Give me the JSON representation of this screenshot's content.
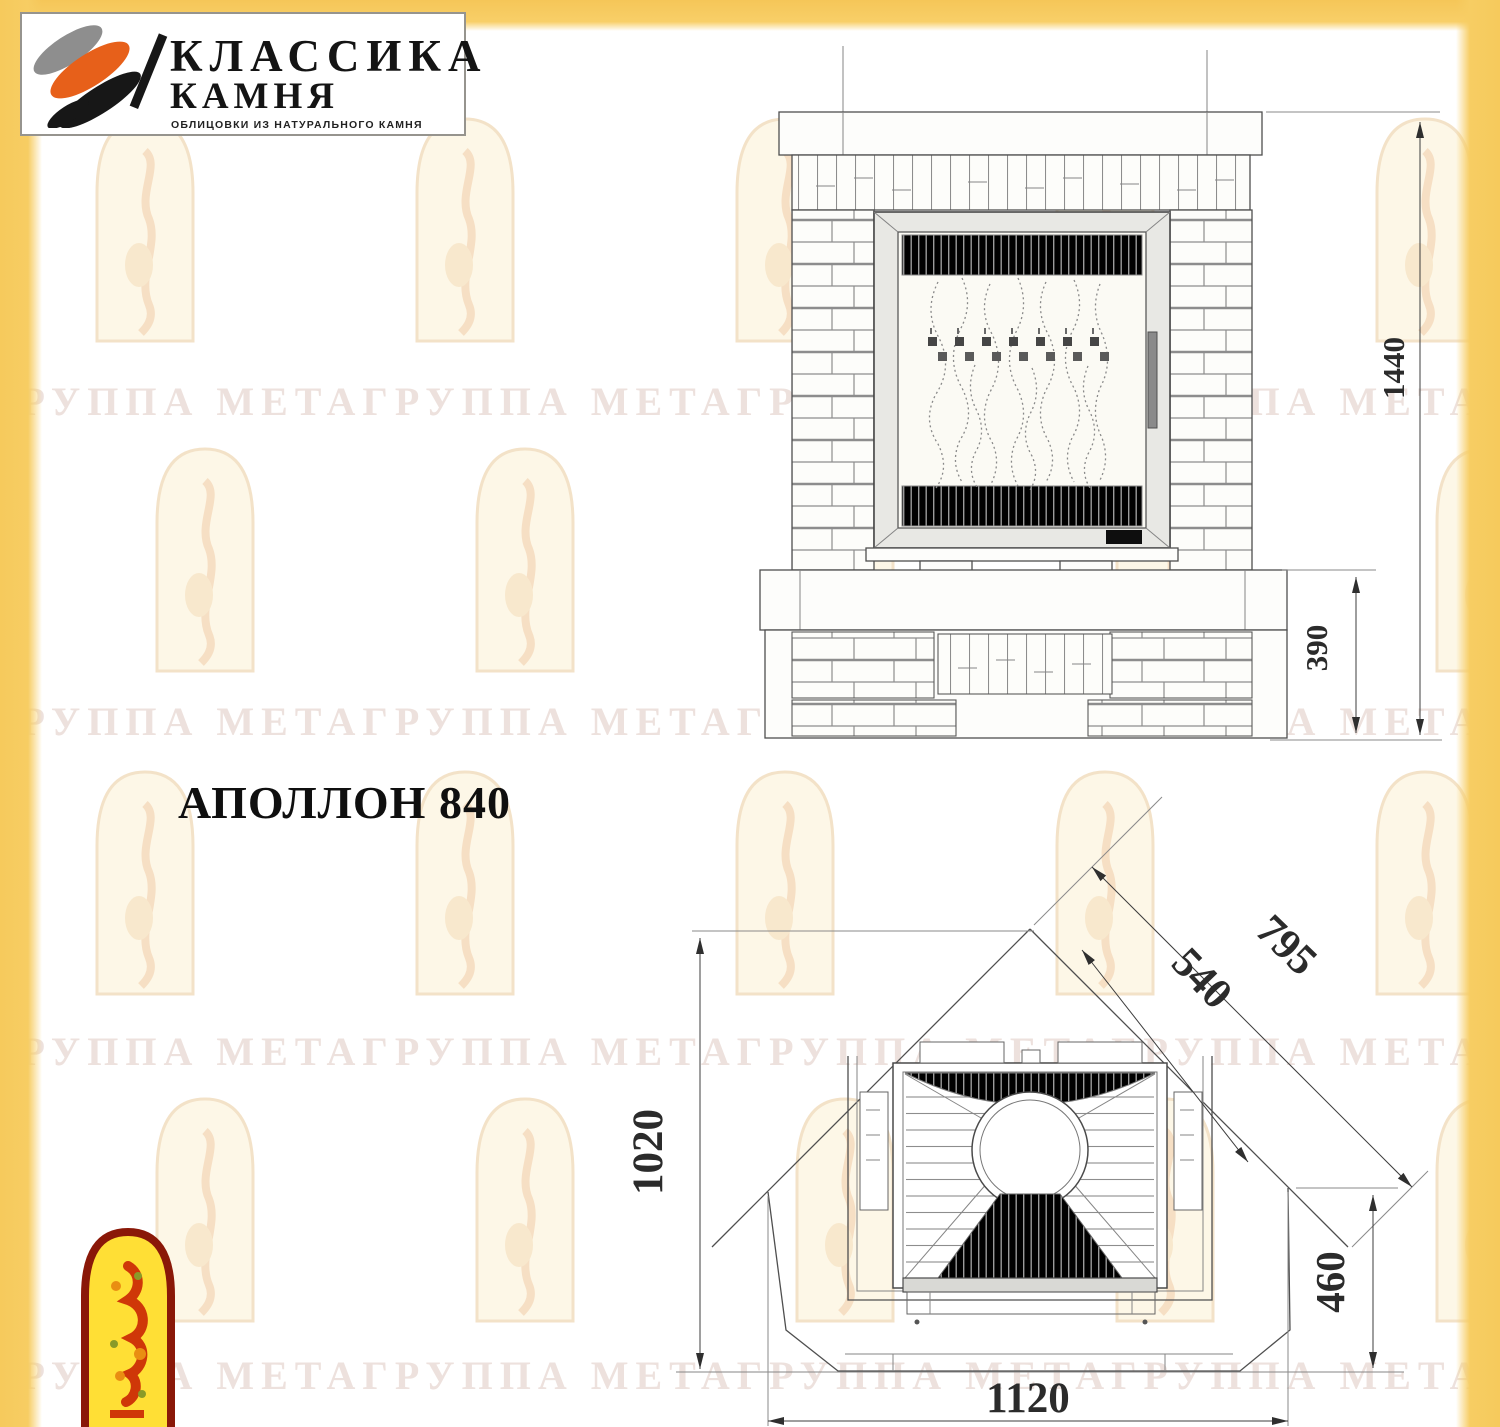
{
  "logo": {
    "brand_line1": "КЛАССИКА",
    "brand_line2": "КАМНЯ",
    "tagline": "ОБЛИЦОВКИ ИЗ НАТУРАЛЬНОГО КАМНЯ"
  },
  "title": "АПОЛЛОН 840",
  "front_view": {
    "height_total": "1440",
    "height_base": "390"
  },
  "plan_view": {
    "depth": "1020",
    "side_outer": "795",
    "side_inner": "540",
    "front_depth": "460",
    "width": "1120"
  },
  "watermark": {
    "text": "ГРУППА МЕТАГРУППА МЕТАГРУППА МЕТАГРУППА МЕТА"
  },
  "colors": {
    "accent_yellow": "#f7cd63",
    "logo_orange": "#e7601a",
    "corner_logo_red": "#8a1808",
    "corner_logo_yellow": "#ffdf35",
    "drawing_line": "#4f4f4f"
  }
}
